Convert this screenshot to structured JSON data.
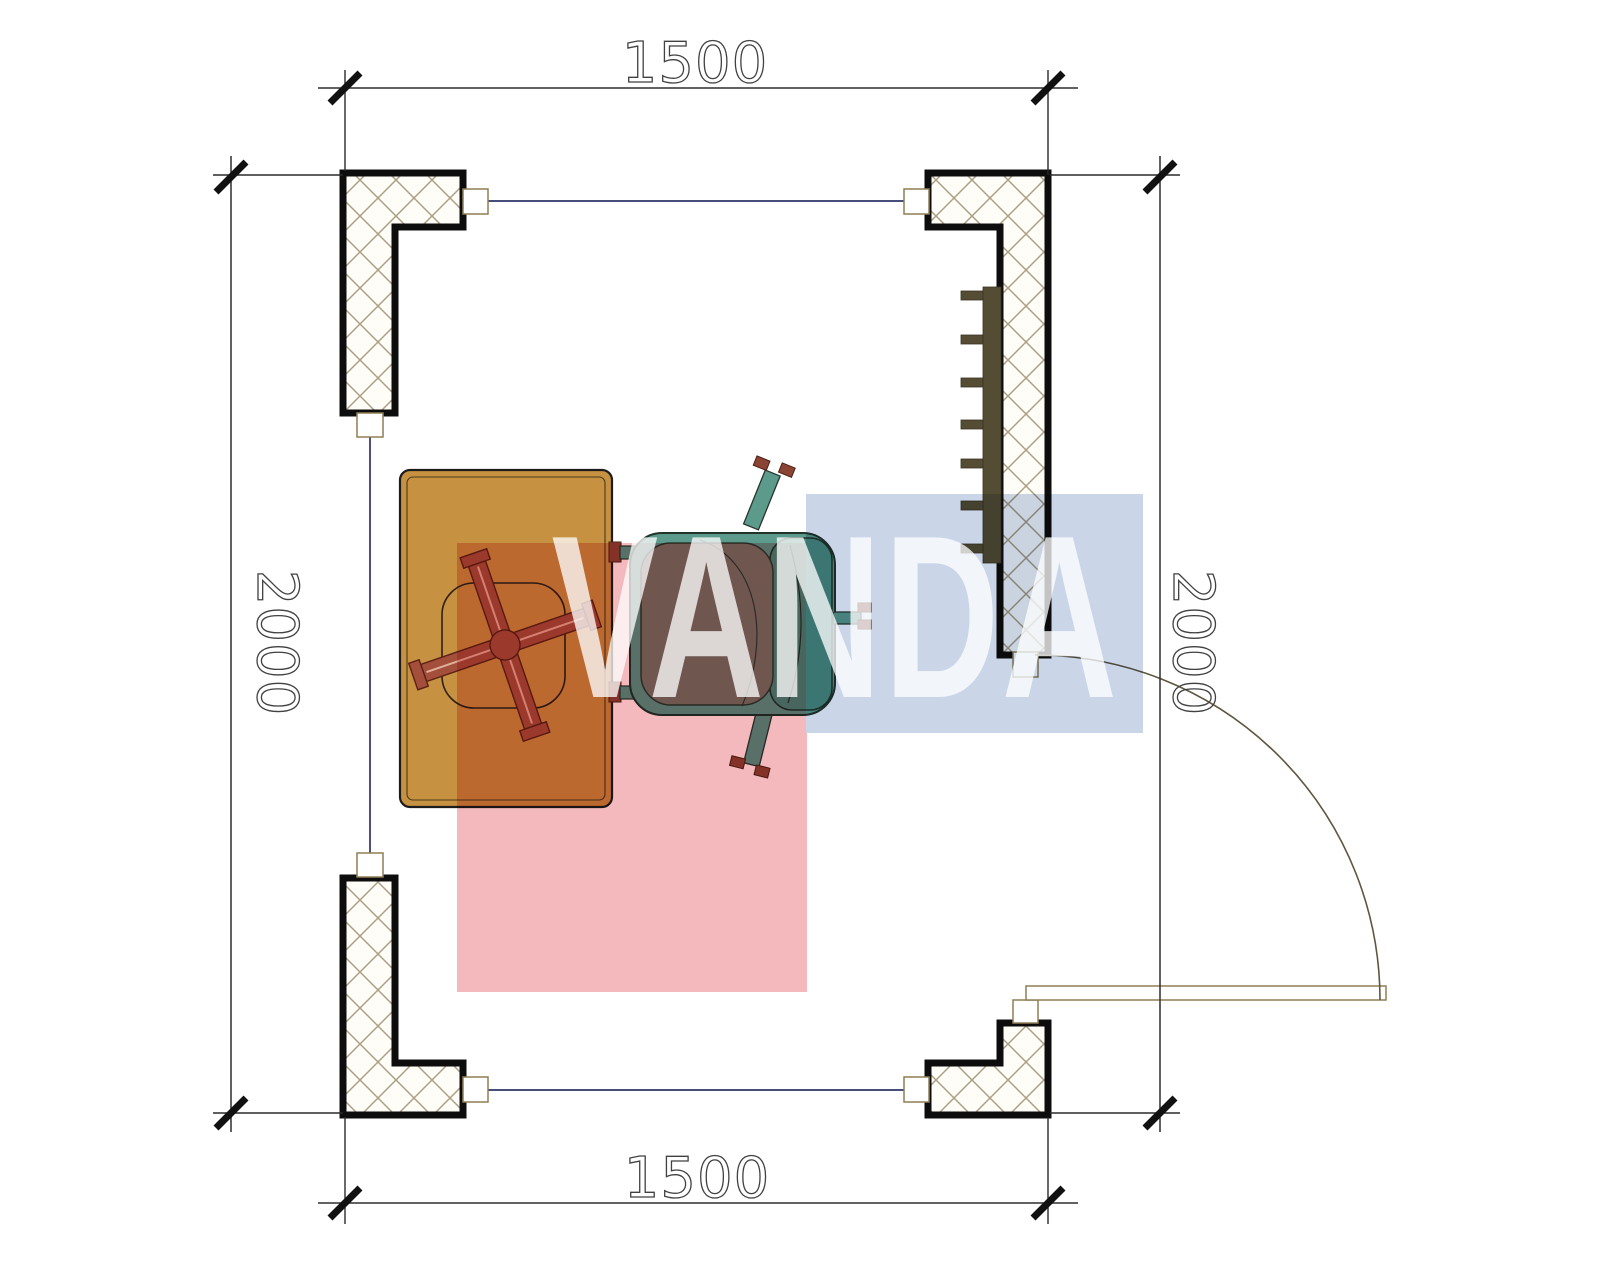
{
  "drawing": {
    "dimensions": {
      "top_width_mm": "1500",
      "bottom_width_mm": "1500",
      "left_height_mm": "2000",
      "right_height_mm": "2000"
    }
  },
  "watermark": {
    "text": "VANDA",
    "pink_block_color": "#f3b9bc",
    "blue_block_color": "#cad6e8"
  },
  "palette": {
    "wall_outline": "#0d0d0d",
    "wall_hatch": "#ac9f83",
    "window_line": "#2b3468",
    "desk_top": "#c69140",
    "chair_base": "#a34f3b",
    "chair_base_dark": "#5c2014",
    "armchair_shell": "#5c9a8b",
    "armchair_backrest": "#4b8d7e",
    "armchair_cushion": "#74776a",
    "armchair_feet": "#8b4434",
    "radiator": "#554d33"
  }
}
